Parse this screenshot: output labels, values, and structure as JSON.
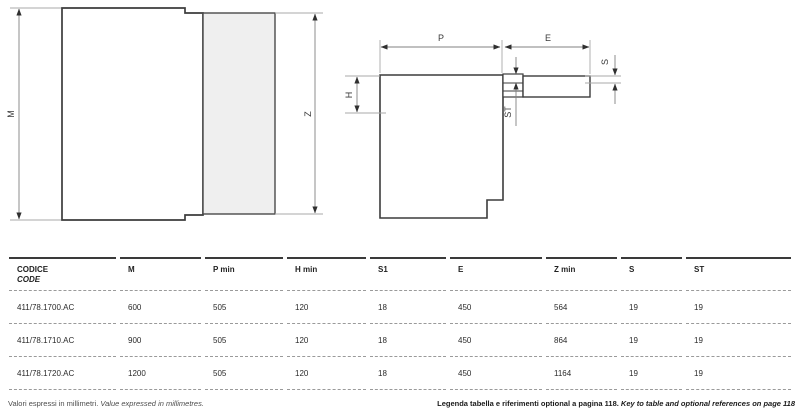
{
  "drawings": {
    "left": {
      "labels": {
        "m": "M",
        "z": "Z"
      }
    },
    "right": {
      "labels": {
        "p": "P",
        "e": "E",
        "h": "H",
        "s": "S",
        "st": "ST"
      }
    }
  },
  "table": {
    "code_header": {
      "it": "CODICE",
      "en": "CODE"
    },
    "headers": [
      "M",
      "P min",
      "H min",
      "S1",
      "E",
      "Z min",
      "S",
      "ST"
    ],
    "rows": [
      {
        "code": "411/78.1700.AC",
        "values": [
          "600",
          "505",
          "120",
          "18",
          "450",
          "564",
          "19",
          "19"
        ]
      },
      {
        "code": "411/78.1710.AC",
        "values": [
          "900",
          "505",
          "120",
          "18",
          "450",
          "864",
          "19",
          "19"
        ]
      },
      {
        "code": "411/78.1720.AC",
        "values": [
          "1200",
          "505",
          "120",
          "18",
          "450",
          "1164",
          "19",
          "19"
        ]
      }
    ]
  },
  "footer": {
    "note_it": "Valori espressi in millimetri.",
    "note_en": "Value expressed in millimetres.",
    "legend_it": "Legenda tabella e riferimenti optional a pagina 118.",
    "legend_en": "Key to table and optional references on page 118"
  },
  "colors": {
    "outline": "#3c3c3c",
    "dimension_line": "#808080",
    "extension_line": "#a8a8a8",
    "panel_fill": "#efefef",
    "table_top_border": "#3a3a3a",
    "row_divider": "#9a9a9a"
  }
}
